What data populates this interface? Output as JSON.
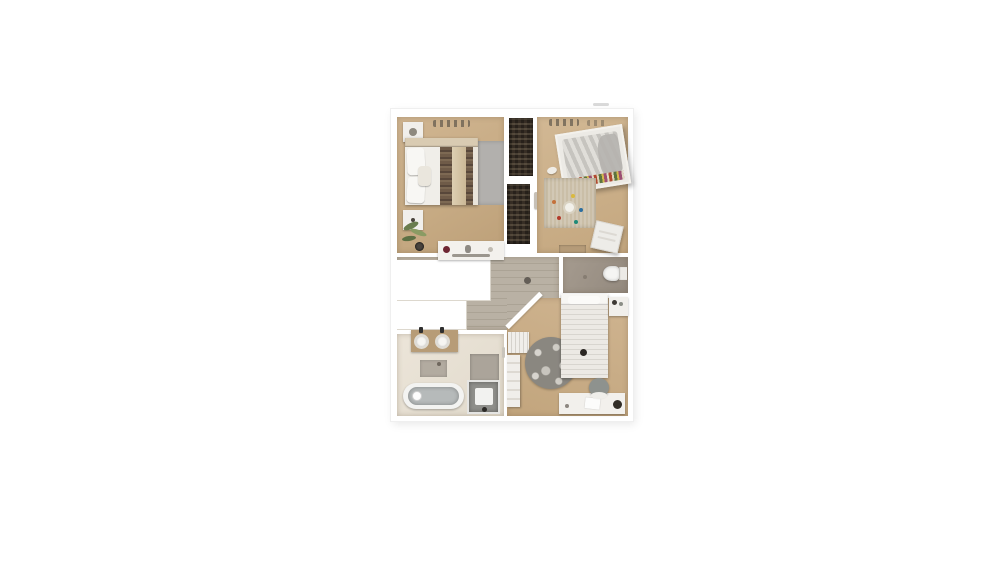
{
  "page": {
    "background_color": "#ffffff",
    "content": "3D rendered top-down floor plan image centered on a blank white page, no visible text or UI controls"
  },
  "floor_plan": {
    "type": "3d_top_down_floor_plan_render",
    "palette": {
      "walls": "#ffffff",
      "bedroom_wood_floor": "#c7ab84",
      "hallway_plank_floor": "#b1a99b",
      "wc_floor": "#9a9085",
      "bathroom_floor": "#e8e1d4",
      "closet_interior": "#372e25",
      "rug_gray": "#b2b0ad",
      "rug_beige": "#cabea7",
      "rug_round_dark": "#8a8780"
    },
    "rooms": [
      {
        "name": "bedroom-top-left",
        "floor": "wood",
        "furniture": [
          "double-bed with white duvet, patterned runner stripes and side pillows",
          "nightstand top-left",
          "nightstand bottom-left",
          "gray area rug",
          "wall decor above headboard",
          "potted plant",
          "white dresser with red vase and small decor"
        ]
      },
      {
        "name": "closet-strip",
        "floor": "none",
        "furniture": [
          "built-in wardrobe upper (dark, filled with clothes)",
          "built-in wardrobe lower (dark, filled with clothes)",
          "door with handle to right bedroom"
        ]
      },
      {
        "name": "bedroom-top-right",
        "floor": "wood",
        "furniture": [
          "slanted double bed with floral quilt edge and gathered gray duvet",
          "beige play rug with white round toy and colored toy dots",
          "white storage basket",
          "wooden bench at wall",
          "wall decor smudges",
          "white slipper pair"
        ]
      },
      {
        "name": "hallway",
        "floor": "gray planks",
        "furniture": [
          "white stairwell opening (L-shaped cutout)",
          "dark ceiling light dot"
        ]
      },
      {
        "name": "wc",
        "floor": "taupe",
        "furniture": [
          "white toilet facing left",
          "small floor dot"
        ]
      },
      {
        "name": "bathroom",
        "floor": "cream",
        "furniture": [
          "wooden vanity with two round white sinks and dark faucets",
          "gray bath mat",
          "gray tiled shower side panel",
          "bathtub with gray interior and drain",
          "shower enclosure with white tray"
        ]
      },
      {
        "name": "bedroom-bottom-right",
        "floor": "wood",
        "furniture": [
          "single bed with ribbed white duvet and headboard",
          "nightstand with dark decor items",
          "round dark floral rug",
          "white desk with papers and dark lamp",
          "gray desk chair with white backrest",
          "white radiator under wall",
          "tall white wardrobe panel",
          "diagonal corner wall",
          "bathroom door handle"
        ]
      }
    ],
    "artifacts": [
      {
        "name": "gray-dash",
        "description": "small light gray dash just above the top-right of the plan"
      }
    ]
  }
}
